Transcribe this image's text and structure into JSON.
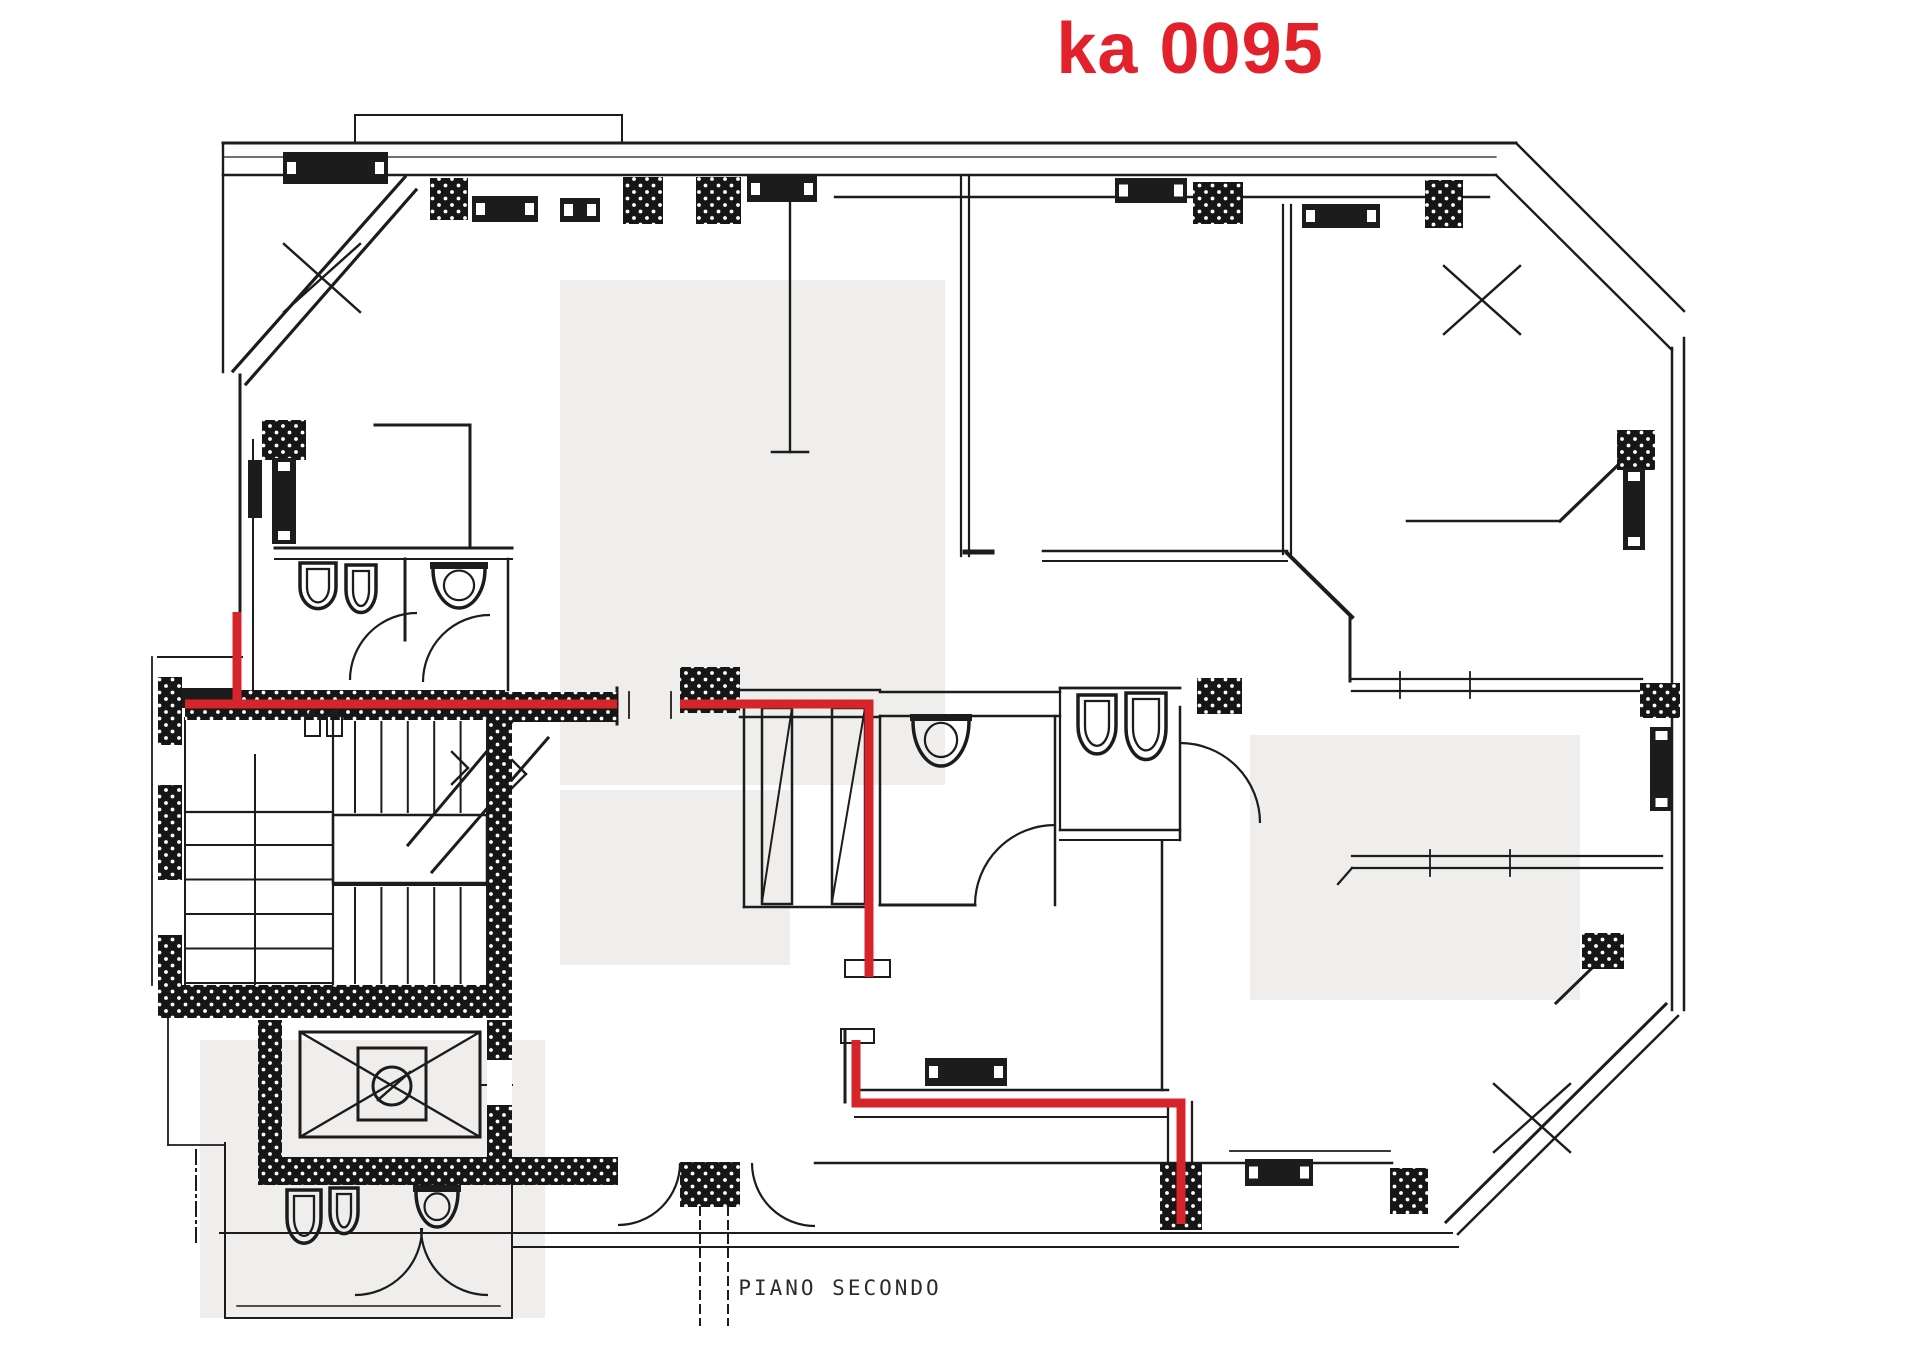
{
  "title": {
    "text": "ka 0095",
    "color": "#e2212a"
  },
  "caption": {
    "text": "PIANO SECONDO"
  },
  "colors": {
    "ink": "#1c1c1c",
    "red": "#d6242b",
    "watermark": "#efeeec",
    "paper": "#ffffff"
  },
  "drawing": {
    "width": 1920,
    "height": 1357,
    "watermarks": [
      [
        560,
        280,
        385,
        505
      ],
      [
        1250,
        735,
        330,
        265
      ],
      [
        200,
        1040,
        345,
        278
      ],
      [
        560,
        790,
        230,
        175
      ]
    ],
    "wall_lines": [
      [
        223,
        143,
        1516,
        143,
        3
      ],
      [
        223,
        157,
        1496,
        157,
        1.2
      ],
      [
        223,
        175,
        1496,
        175,
        2.6
      ],
      [
        835,
        197,
        1489,
        197,
        2.4
      ],
      [
        355,
        115,
        622,
        115,
        2
      ],
      [
        355,
        115,
        355,
        143,
        2
      ],
      [
        622,
        115,
        622,
        143,
        2
      ],
      [
        223,
        143,
        223,
        372,
        2.4
      ],
      [
        405,
        177,
        233,
        371,
        3.2
      ],
      [
        416,
        190,
        246,
        384,
        3.2
      ],
      [
        240,
        375,
        240,
        703,
        3
      ],
      [
        253,
        440,
        253,
        690,
        2
      ],
      [
        375,
        425,
        470,
        425,
        3
      ],
      [
        470,
        425,
        470,
        548,
        3
      ],
      [
        790,
        190,
        790,
        452,
        2.4
      ],
      [
        772,
        452,
        808,
        452,
        2.6
      ],
      [
        961,
        175,
        961,
        556,
        2.2
      ],
      [
        969,
        175,
        969,
        556,
        2.2
      ],
      [
        965,
        552,
        992,
        552,
        5
      ],
      [
        1283,
        205,
        1283,
        554,
        2.2
      ],
      [
        1291,
        205,
        1291,
        554,
        2.2
      ],
      [
        1043,
        551,
        1287,
        551,
        2.6
      ],
      [
        1043,
        561,
        1287,
        561,
        2
      ],
      [
        1287,
        553,
        1352,
        617,
        4
      ],
      [
        1350,
        617,
        1350,
        681,
        3
      ],
      [
        1352,
        679,
        1642,
        679,
        2.3
      ],
      [
        1352,
        691,
        1642,
        691,
        2.3
      ],
      [
        1352,
        856,
        1662,
        856,
        2.3
      ],
      [
        1352,
        868,
        1662,
        868,
        2.3
      ],
      [
        1338,
        884,
        1352,
        868,
        2.3
      ],
      [
        1672,
        348,
        1672,
        1010,
        2.5
      ],
      [
        1684,
        338,
        1684,
        1010,
        2.5
      ],
      [
        1516,
        143,
        1684,
        311,
        2.4
      ],
      [
        1496,
        175,
        1672,
        350,
        2.4
      ],
      [
        1666,
        1004,
        1446,
        1222,
        3
      ],
      [
        1678,
        1016,
        1458,
        1234,
        2.5
      ],
      [
        1407,
        521,
        1560,
        521,
        2.5
      ],
      [
        1560,
        521,
        1617,
        466,
        3.2
      ],
      [
        1592,
        968,
        1556,
        1003,
        3
      ],
      [
        152,
        657,
        152,
        985,
        1.8
      ],
      [
        158,
        657,
        242,
        657,
        2
      ],
      [
        168,
        1018,
        168,
        1145,
        1.8
      ],
      [
        168,
        1145,
        225,
        1145,
        1.8
      ],
      [
        225,
        1143,
        225,
        1318,
        2
      ],
      [
        225,
        1318,
        512,
        1318,
        2
      ],
      [
        237,
        1306,
        500,
        1306,
        1.5
      ],
      [
        512,
        1185,
        512,
        1318,
        2
      ],
      [
        220,
        1233,
        1452,
        1233,
        2
      ],
      [
        512,
        1247,
        1458,
        1247,
        2
      ],
      [
        815,
        1163,
        1245,
        1163,
        2.5
      ],
      [
        1313,
        1163,
        1392,
        1163,
        2.5
      ],
      [
        1230,
        1151,
        1390,
        1151,
        1.8
      ],
      [
        275,
        548,
        512,
        548,
        3
      ],
      [
        275,
        559,
        512,
        559,
        2
      ],
      [
        405,
        559,
        405,
        640,
        3
      ],
      [
        508,
        559,
        508,
        690,
        2.5
      ],
      [
        617,
        688,
        617,
        724,
        3
      ],
      [
        629,
        692,
        629,
        718,
        1.8
      ],
      [
        671,
        692,
        671,
        718,
        1.8
      ],
      [
        740,
        690,
        880,
        690,
        2.5
      ],
      [
        740,
        717,
        880,
        717,
        2.5
      ],
      [
        880,
        692,
        1060,
        692,
        2.5
      ],
      [
        880,
        716,
        1060,
        716,
        2.5
      ],
      [
        880,
        716,
        880,
        905,
        2.5
      ],
      [
        880,
        905,
        975,
        905,
        3
      ],
      [
        1055,
        716,
        1055,
        905,
        2.5
      ],
      [
        1060,
        688,
        1180,
        688,
        2.8
      ],
      [
        1060,
        688,
        1060,
        830,
        2.2
      ],
      [
        1180,
        707,
        1180,
        840,
        2.5
      ],
      [
        1060,
        830,
        1180,
        830,
        2.5
      ],
      [
        1060,
        840,
        1180,
        840,
        2
      ],
      [
        1162,
        842,
        1162,
        1090,
        2.5
      ],
      [
        744,
        705,
        744,
        907,
        2.5
      ],
      [
        744,
        907,
        870,
        907,
        2.5
      ],
      [
        845,
        1030,
        845,
        1102,
        3
      ],
      [
        855,
        1090,
        1168,
        1090,
        2.5
      ],
      [
        855,
        1117,
        1168,
        1117,
        2
      ],
      [
        1168,
        1102,
        1168,
        1163,
        2.3
      ],
      [
        1192,
        1102,
        1192,
        1163,
        2.3
      ],
      [
        185,
        718,
        185,
        985,
        2
      ],
      [
        487,
        718,
        487,
        985,
        2
      ],
      [
        333,
        718,
        333,
        985,
        2.2
      ],
      [
        185,
        812,
        333,
        812,
        2.2
      ],
      [
        255,
        755,
        255,
        985,
        2
      ],
      [
        333,
        885,
        487,
        885,
        2
      ],
      [
        408,
        845,
        520,
        712,
        3
      ],
      [
        432,
        872,
        548,
        738,
        3
      ],
      [
        452,
        752,
        468,
        768,
        2.4
      ],
      [
        452,
        784,
        468,
        768,
        2.4
      ],
      [
        512,
        760,
        526,
        774,
        2.4
      ],
      [
        512,
        788,
        526,
        774,
        2.4
      ],
      [
        300,
        1032,
        480,
        1137,
        2.4
      ],
      [
        300,
        1137,
        480,
        1032,
        2.4
      ],
      [
        792,
        708,
        762,
        902,
        2
      ],
      [
        865,
        708,
        832,
        902,
        2
      ],
      [
        480,
        1085,
        512,
        1085,
        2
      ],
      [
        378,
        1100,
        410,
        1072,
        2.5
      ],
      [
        1400,
        672,
        1400,
        698,
        1.8
      ],
      [
        1470,
        672,
        1470,
        698,
        1.8
      ],
      [
        1430,
        850,
        1430,
        876,
        1.8
      ],
      [
        1510,
        850,
        1510,
        876,
        1.8
      ],
      [
        693,
        1205,
        737,
        1205,
        2
      ]
    ],
    "hatch_rects": [
      [
        185,
        690,
        320,
        30
      ],
      [
        505,
        692,
        113,
        30
      ],
      [
        158,
        677,
        24,
        308
      ],
      [
        158,
        985,
        354,
        33
      ],
      [
        487,
        718,
        25,
        267
      ],
      [
        258,
        1020,
        24,
        137
      ],
      [
        487,
        1020,
        25,
        137
      ],
      [
        258,
        1157,
        360,
        28
      ],
      [
        680,
        1162,
        60,
        45
      ],
      [
        1160,
        1163,
        42,
        67
      ],
      [
        1390,
        1168,
        38,
        46
      ],
      [
        680,
        667,
        60,
        46
      ],
      [
        1197,
        678,
        45,
        36
      ],
      [
        430,
        178,
        38,
        42
      ],
      [
        623,
        177,
        40,
        47
      ],
      [
        696,
        177,
        45,
        47
      ],
      [
        1193,
        182,
        50,
        42
      ],
      [
        1425,
        180,
        38,
        48
      ],
      [
        262,
        420,
        44,
        40
      ],
      [
        1617,
        430,
        38,
        40
      ],
      [
        1640,
        683,
        40,
        35
      ],
      [
        1582,
        933,
        42,
        36
      ]
    ],
    "white_rects": [
      [
        158,
        745,
        24,
        40
      ],
      [
        158,
        880,
        24,
        55
      ],
      [
        487,
        1060,
        25,
        45
      ]
    ],
    "solid_rects": [
      [
        182,
        688,
        54,
        20
      ],
      [
        248,
        460,
        14,
        58
      ]
    ],
    "radiators": [
      [
        283,
        152,
        105,
        32,
        "h"
      ],
      [
        472,
        196,
        66,
        26,
        "h"
      ],
      [
        560,
        198,
        40,
        24,
        "h"
      ],
      [
        747,
        176,
        70,
        26,
        "h"
      ],
      [
        1115,
        178,
        72,
        25,
        "h"
      ],
      [
        1302,
        204,
        78,
        24,
        "h"
      ],
      [
        1245,
        1159,
        68,
        27,
        "h"
      ],
      [
        925,
        1058,
        82,
        28,
        "h"
      ],
      [
        272,
        458,
        24,
        86,
        "v"
      ],
      [
        1623,
        468,
        22,
        82,
        "v"
      ],
      [
        1650,
        727,
        23,
        84,
        "v"
      ]
    ],
    "outline_rects": [
      [
        300,
        1032,
        180,
        105,
        3
      ],
      [
        358,
        1048,
        68,
        72,
        3
      ],
      [
        333,
        815,
        154,
        68,
        2.5
      ],
      [
        762,
        708,
        30,
        196,
        2.5
      ],
      [
        832,
        708,
        33,
        196,
        2.5
      ],
      [
        845,
        960,
        45,
        17,
        2
      ],
      [
        841,
        1029,
        33,
        14,
        2
      ]
    ],
    "tread_groups": [
      {
        "orient": "v",
        "from": 355,
        "to": 487,
        "count": 6,
        "a": 722,
        "b": 812
      },
      {
        "orient": "v",
        "from": 355,
        "to": 487,
        "count": 6,
        "a": 888,
        "b": 983
      },
      {
        "orient": "h",
        "from": 845,
        "to": 983,
        "count": 5,
        "a": 185,
        "b": 333
      }
    ],
    "fixtures": [
      {
        "type": "wc",
        "x": 300,
        "y": 563,
        "w": 36,
        "h": 48
      },
      {
        "type": "wc",
        "x": 346,
        "y": 565,
        "w": 30,
        "h": 50
      },
      {
        "type": "bowl",
        "x": 430,
        "y": 562,
        "w": 58,
        "h": 46
      },
      {
        "type": "wc",
        "x": 1078,
        "y": 695,
        "w": 38,
        "h": 62
      },
      {
        "type": "wc",
        "x": 1126,
        "y": 693,
        "w": 40,
        "h": 70
      },
      {
        "type": "bowl",
        "x": 910,
        "y": 714,
        "w": 62,
        "h": 52
      },
      {
        "type": "wc",
        "x": 287,
        "y": 1190,
        "w": 34,
        "h": 56
      },
      {
        "type": "wc",
        "x": 330,
        "y": 1188,
        "w": 28,
        "h": 48
      },
      {
        "type": "bowl",
        "x": 413,
        "y": 1185,
        "w": 48,
        "h": 42
      },
      {
        "type": "mini",
        "x": 305,
        "y": 716,
        "w": 15,
        "h": 20
      },
      {
        "type": "mini",
        "x": 327,
        "y": 716,
        "w": 15,
        "h": 20
      }
    ],
    "door_arcs": [
      "M 417,613 A 67,67 0 0 0 350,680",
      "M 490,615 A 67,67 0 0 0 423,682",
      "M 1055,825 A 80,80 0 0 0 975,905",
      "M 1180,743 A 80,80 0 0 1 1260,823",
      "M 680,1163 A 62,62 0 0 1 618,1225",
      "M 752,1163 A 63,63 0 0 0 815,1226",
      "M 422,1228 A 67,67 0 0 1 355,1295",
      "M 421,1228 A 67,67 0 0 0 488,1295"
    ],
    "red_paths": [
      "M 237,612 L 237,705",
      "M 185,704 L 617,704",
      "M 680,704 L 869,704 L 869,977",
      "M 856,1040 L 856,1103 L 1181,1103 L 1181,1224"
    ],
    "x_marks": [
      [
        322,
        278
      ],
      [
        1482,
        300
      ],
      [
        1532,
        1118
      ]
    ],
    "dashed_lines": [
      [
        700,
        1207,
        700,
        1325,
        "8 6"
      ],
      [
        728,
        1207,
        728,
        1325,
        "8 6"
      ],
      [
        196,
        1150,
        196,
        1245,
        "14 5 2 5"
      ]
    ],
    "circles": [
      {
        "cx": 392,
        "cy": 1086,
        "r": 19,
        "sw": 3
      },
      {
        "cx": 312,
        "cy": 713,
        "r": 3.4,
        "sw": 0
      },
      {
        "cx": 334,
        "cy": 713,
        "r": 3.4,
        "sw": 0
      }
    ]
  }
}
